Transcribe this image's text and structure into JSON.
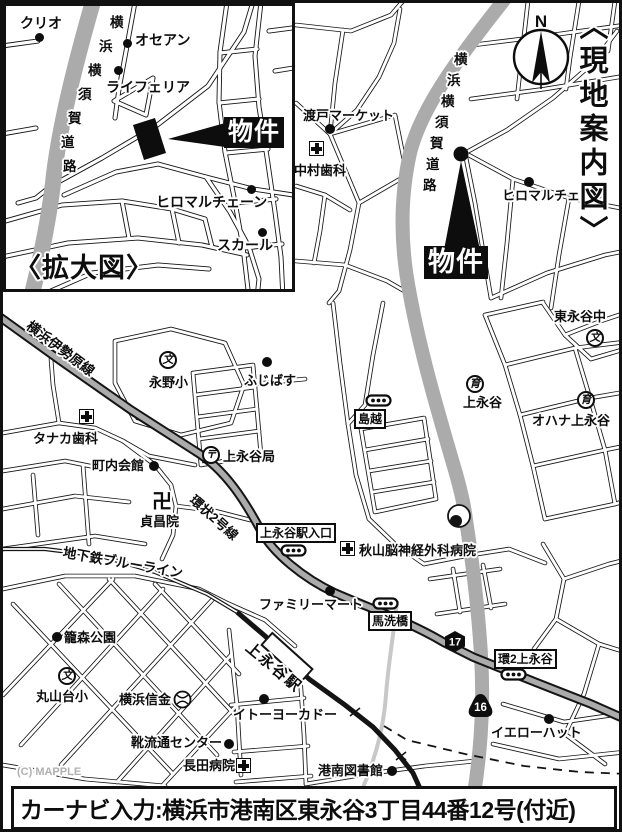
{
  "header": {
    "guide_title": "〈現地案内図〉",
    "compass_n": "N"
  },
  "inset": {
    "title": "〈拡大図〉",
    "property_label": "物件",
    "pois": {
      "kurio": "クリオ",
      "osean": "オセアン",
      "raiferia": "ライフェリア",
      "hiromaru": "ヒロマルチェーン",
      "sukaru": "スカール"
    }
  },
  "roads": {
    "yokosuka_chars": [
      "横",
      "浜",
      "横",
      "須",
      "賀",
      "道",
      "路"
    ],
    "isehara": "横浜伊勢原線",
    "kanjo2": "環状2号線",
    "blueline": "地下鉄ブルーライン",
    "station": "上永谷駅"
  },
  "routes": {
    "r16": "16",
    "r17": "17"
  },
  "main": {
    "property_label": "物件",
    "pois": {
      "watarido": "渡戸マーケット",
      "nakamura": "中村歯科",
      "hiromaru": "ヒロマルチェーン",
      "higashinagaya_jhs": "東永谷中",
      "kaminagaya_ikuen": "上永谷",
      "ohana": "オハナ上永谷",
      "nagano_es": "永野小",
      "fujibasu": "ふじばす",
      "tanaka": "タナカ歯科",
      "chonaikaikan": "町内会館",
      "kaminagaya_po": "上永谷局",
      "teishoin": "貞昌院",
      "akiyama": "秋山脳神経外科病院",
      "familymart": "ファミリーマート",
      "kagomori": "籠森公園",
      "maruyamadai_es": "丸山台小",
      "shinkin": "横浜信金",
      "itoyokado": "イトーヨーカドー",
      "kutsu": "靴流通センター",
      "nagata": "長田病院",
      "konan_lib": "港南図書館",
      "yellowhat": "イエローハット"
    },
    "bus_stops": {
      "shimagoshi": "島越",
      "kaminagaya_ent": "上永谷駅入口",
      "umaarai": "馬洗橋",
      "kan2": "環2上永谷"
    }
  },
  "symbols": {
    "school": "文",
    "nursery": "育",
    "post": "〒",
    "temple": "卍"
  },
  "footer": {
    "copyright": "(C) MAPPLE",
    "navi": "カーナビ入力:横浜市港南区東永谷3丁目44番12号(付近)"
  },
  "colors": {
    "road_gray": "#ababab",
    "river_gray": "#c8c8c8",
    "ink": "#0d0d0d"
  }
}
